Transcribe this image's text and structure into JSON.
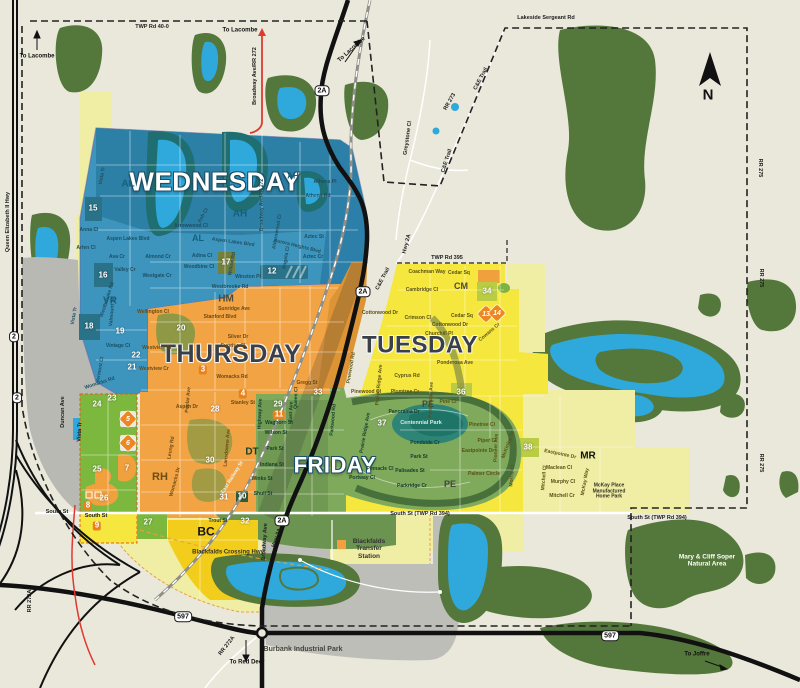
{
  "map_name": "collection-zone-map",
  "colors": {
    "background": "#EAE8DB",
    "forest": "#54783B",
    "water": "#2FA8DC",
    "wednesday": "#3D95BD",
    "thursday": "#F2A444",
    "tuesday": "#F6E73E",
    "friday": "#7FA95B",
    "pale_yellow": "#F0EDA4",
    "west_green": "#7CB83E",
    "bc_gold": "#F2CD1C",
    "gray": "#BEBEB9",
    "marker_orange": "#EE8722",
    "red_road": "#E03A2F"
  },
  "day_zones": [
    {
      "label": "WEDNESDAY",
      "style": "light",
      "x": 215,
      "y": 182,
      "size": 26
    },
    {
      "label": "THURSDAY",
      "style": "dark",
      "x": 231,
      "y": 354,
      "size": 25
    },
    {
      "label": "TUESDAY",
      "style": "dark",
      "x": 420,
      "y": 346,
      "size": 24
    },
    {
      "label": "FRIDAY",
      "style": "light",
      "x": 335,
      "y": 466,
      "size": 22
    }
  ],
  "zone_codes": [
    {
      "code": "AL",
      "x": 128,
      "y": 184,
      "size": 10,
      "color": "#15607e"
    },
    {
      "code": "AH",
      "x": 293,
      "y": 177,
      "size": 8,
      "color": "#15607e"
    },
    {
      "code": "AH",
      "x": 240,
      "y": 214,
      "size": 10,
      "color": "#15607e"
    },
    {
      "code": "AL",
      "x": 198,
      "y": 238,
      "size": 9,
      "color": "#15607e"
    },
    {
      "code": "VR",
      "x": 110,
      "y": 301,
      "size": 10,
      "color": "#15607e"
    },
    {
      "code": "HM",
      "x": 226,
      "y": 299,
      "size": 10,
      "color": "#4a4a3a"
    },
    {
      "code": "DT",
      "x": 252,
      "y": 452,
      "size": 10,
      "color": "#17402c"
    },
    {
      "code": "PE",
      "x": 428,
      "y": 404,
      "size": 9,
      "color": "#45473d"
    },
    {
      "code": "PE",
      "x": 450,
      "y": 484,
      "size": 9,
      "color": "#45473d"
    },
    {
      "code": "CM",
      "x": 461,
      "y": 286,
      "size": 9,
      "color": "#4a4a42"
    },
    {
      "code": "MR",
      "x": 588,
      "y": 456,
      "size": 10,
      "color": "#111111"
    },
    {
      "code": "RH",
      "x": 160,
      "y": 477,
      "size": 11,
      "color": "#6b4d15"
    },
    {
      "code": "BC",
      "x": 206,
      "y": 532,
      "size": 12,
      "color": "#111111"
    }
  ],
  "badges": [
    {
      "n": "15",
      "x": 93,
      "y": 209
    },
    {
      "n": "16",
      "x": 103,
      "y": 276
    },
    {
      "n": "17",
      "x": 226,
      "y": 263
    },
    {
      "n": "18",
      "x": 89,
      "y": 327
    },
    {
      "n": "19",
      "x": 120,
      "y": 332
    },
    {
      "n": "20",
      "x": 181,
      "y": 329
    },
    {
      "n": "21",
      "x": 132,
      "y": 368
    },
    {
      "n": "22",
      "x": 136,
      "y": 356
    },
    {
      "n": "23",
      "x": 112,
      "y": 399
    },
    {
      "n": "24",
      "x": 97,
      "y": 405
    },
    {
      "n": "25",
      "x": 97,
      "y": 470
    },
    {
      "n": "26",
      "x": 104,
      "y": 499
    },
    {
      "n": "27",
      "x": 148,
      "y": 523
    },
    {
      "n": "28",
      "x": 215,
      "y": 410
    },
    {
      "n": "29",
      "x": 278,
      "y": 405
    },
    {
      "n": "30",
      "x": 210,
      "y": 461
    },
    {
      "n": "31",
      "x": 224,
      "y": 498
    },
    {
      "n": "32",
      "x": 245,
      "y": 522
    },
    {
      "n": "33",
      "x": 318,
      "y": 393
    },
    {
      "n": "34",
      "x": 487,
      "y": 292
    },
    {
      "n": "36",
      "x": 461,
      "y": 393
    },
    {
      "n": "37",
      "x": 382,
      "y": 424
    },
    {
      "n": "38",
      "x": 528,
      "y": 448
    },
    {
      "n": "10",
      "x": 242,
      "y": 497
    },
    {
      "n": "12",
      "x": 272,
      "y": 272
    },
    {
      "n": "11",
      "x": 279,
      "y": 415,
      "bg": "orange"
    },
    {
      "n": "3",
      "x": 203,
      "y": 370,
      "bg": "orange"
    },
    {
      "n": "4",
      "x": 243,
      "y": 394,
      "bg": "orange"
    },
    {
      "n": "7",
      "x": 127,
      "y": 469
    },
    {
      "n": "8",
      "x": 88,
      "y": 506,
      "bg": "orange"
    },
    {
      "n": "9",
      "x": 97,
      "y": 526,
      "bg": "orange"
    }
  ],
  "markers": [
    {
      "n": "5",
      "x": 128,
      "y": 419
    },
    {
      "n": "6",
      "x": 128,
      "y": 443
    },
    {
      "n": "13",
      "x": 486,
      "y": 314
    },
    {
      "n": "14",
      "x": 497,
      "y": 313
    }
  ],
  "shields": [
    {
      "t": "2A",
      "x": 322,
      "y": 91
    },
    {
      "t": "2A",
      "x": 363,
      "y": 292
    },
    {
      "t": "2A",
      "x": 282,
      "y": 521
    },
    {
      "t": "2",
      "x": 14,
      "y": 337
    },
    {
      "t": "2",
      "x": 17,
      "y": 398
    },
    {
      "t": "597",
      "x": 183,
      "y": 617
    },
    {
      "t": "597",
      "x": 610,
      "y": 636
    }
  ],
  "streets": [
    {
      "t": "Vista Tr",
      "x": 103,
      "y": 176,
      "r": -80,
      "c": "s-b"
    },
    {
      "t": "Anna Cl",
      "x": 89,
      "y": 231,
      "c": "s-b"
    },
    {
      "t": "Aspen Lakes Blvd",
      "x": 128,
      "y": 240,
      "c": "s-b"
    },
    {
      "t": "Arlen Cl",
      "x": 86,
      "y": 249,
      "c": "s-b"
    },
    {
      "t": "Ava Cr",
      "x": 117,
      "y": 258,
      "c": "s-b"
    },
    {
      "t": "Valley Cr",
      "x": 125,
      "y": 271,
      "c": "s-b"
    },
    {
      "t": "Vista Tr",
      "x": 75,
      "y": 316,
      "r": -80,
      "c": "s-b"
    },
    {
      "t": "Valmount St",
      "x": 113,
      "y": 312,
      "r": -85,
      "c": "s-b"
    },
    {
      "t": "Westbrooke Rd",
      "x": 108,
      "y": 300,
      "r": -72,
      "c": "s-b"
    },
    {
      "t": "Vintage Cl",
      "x": 118,
      "y": 347,
      "c": "s-b"
    },
    {
      "t": "Vermont Cl",
      "x": 101,
      "y": 370,
      "r": -80,
      "c": "s-b"
    },
    {
      "t": "Womacks Rd",
      "x": 100,
      "y": 384,
      "r": -18,
      "c": "s-b"
    },
    {
      "t": "Westgate Cr",
      "x": 157,
      "y": 277,
      "c": "s-b"
    },
    {
      "t": "Almond Cr",
      "x": 158,
      "y": 258,
      "c": "s-b"
    },
    {
      "t": "Arrowwood Cl",
      "x": 191,
      "y": 227,
      "c": "s-b"
    },
    {
      "t": "Ash Cl",
      "x": 204,
      "y": 216,
      "r": -60,
      "c": "s-b"
    },
    {
      "t": "Adina Cl",
      "x": 202,
      "y": 257,
      "c": "s-b"
    },
    {
      "t": "Woodbine Cl",
      "x": 199,
      "y": 268,
      "c": "s-b"
    },
    {
      "t": "Willow Rd",
      "x": 233,
      "y": 264,
      "r": -80,
      "c": "s-b"
    },
    {
      "t": "Winston Pl",
      "x": 248,
      "y": 278,
      "c": "s-b"
    },
    {
      "t": "Westbrooke Rd",
      "x": 230,
      "y": 288,
      "c": "s-b"
    },
    {
      "t": "Aspen Lakes Blvd",
      "x": 233,
      "y": 243,
      "r": 8,
      "c": "s-b"
    },
    {
      "t": "Broadway Ave/RR 272",
      "x": 263,
      "y": 205,
      "r": -90,
      "c": "s-b"
    },
    {
      "t": "Athens Pl",
      "x": 325,
      "y": 183,
      "c": "s-b"
    },
    {
      "t": "Athens Rd",
      "x": 318,
      "y": 197,
      "c": "s-b"
    },
    {
      "t": "Aurora Heights Blvd",
      "x": 297,
      "y": 247,
      "r": 14,
      "c": "s-b"
    },
    {
      "t": "Aztec St",
      "x": 314,
      "y": 238,
      "c": "s-b"
    },
    {
      "t": "Aztec Cr",
      "x": 313,
      "y": 258,
      "c": "s-b"
    },
    {
      "t": "Aldernwood Cl",
      "x": 278,
      "y": 232,
      "r": -80,
      "c": "s-b"
    },
    {
      "t": "Angela Cl",
      "x": 287,
      "y": 258,
      "r": -80,
      "c": "s-b"
    },
    {
      "t": "Wellington Cl",
      "x": 153,
      "y": 313,
      "c": "s-o"
    },
    {
      "t": "Sunridge Ave",
      "x": 234,
      "y": 310,
      "c": "s-o"
    },
    {
      "t": "Stanford Blvd",
      "x": 220,
      "y": 318,
      "c": "s-o"
    },
    {
      "t": "Silver Dr",
      "x": 238,
      "y": 338,
      "c": "s-o"
    },
    {
      "t": "Sunrise Cl",
      "x": 233,
      "y": 347,
      "c": "s-o"
    },
    {
      "t": "Westview Cr",
      "x": 157,
      "y": 349,
      "c": "s-o"
    },
    {
      "t": "Westview Cr",
      "x": 154,
      "y": 370,
      "c": "s-o"
    },
    {
      "t": "Womacks Rd",
      "x": 232,
      "y": 378,
      "c": "s-o"
    },
    {
      "t": "Gregg St",
      "x": 307,
      "y": 384,
      "c": "s-o"
    },
    {
      "t": "Aspen Dr",
      "x": 187,
      "y": 408,
      "c": "s-o"
    },
    {
      "t": "Stanley St",
      "x": 243,
      "y": 404,
      "c": "s-o"
    },
    {
      "t": "Poplar Ave",
      "x": 189,
      "y": 400,
      "r": -85,
      "c": "s-o"
    },
    {
      "t": "Lansdowne Ave",
      "x": 228,
      "y": 448,
      "r": -85,
      "c": "s-o"
    },
    {
      "t": "Leung Rd",
      "x": 172,
      "y": 448,
      "r": -80,
      "c": "s-o"
    },
    {
      "t": "Womacks Dr",
      "x": 176,
      "y": 482,
      "r": -75,
      "c": "s-o"
    },
    {
      "t": "Waghorn St",
      "x": 279,
      "y": 424,
      "c": "s-g"
    },
    {
      "t": "Wilson St",
      "x": 276,
      "y": 434,
      "c": "s-g"
    },
    {
      "t": "Park St",
      "x": 275,
      "y": 450,
      "c": "s-g"
    },
    {
      "t": "East Ave",
      "x": 292,
      "y": 412,
      "r": -88,
      "c": "s-g"
    },
    {
      "t": "Highway Ave",
      "x": 261,
      "y": 414,
      "r": -88,
      "c": "s-g"
    },
    {
      "t": "Queen Cl",
      "x": 297,
      "y": 398,
      "r": -88,
      "c": "s-g"
    },
    {
      "t": "Indiana St",
      "x": 272,
      "y": 466,
      "c": "s-g"
    },
    {
      "t": "Winks St",
      "x": 262,
      "y": 480,
      "c": "s-g"
    },
    {
      "t": "Shull St",
      "x": 263,
      "y": 495,
      "c": "s-g"
    },
    {
      "t": "Trout St",
      "x": 218,
      "y": 522,
      "c": "s-g"
    },
    {
      "t": "East Railway St",
      "x": 233,
      "y": 478,
      "r": -58,
      "c": "s-w"
    },
    {
      "t": "Panorama Dr",
      "x": 404,
      "y": 413,
      "c": "s-g"
    },
    {
      "t": "Pondside Cr",
      "x": 425,
      "y": 444,
      "c": "s-g"
    },
    {
      "t": "Park St",
      "x": 419,
      "y": 458,
      "c": "s-g"
    },
    {
      "t": "Pinnacle Cl",
      "x": 380,
      "y": 470,
      "c": "s-g"
    },
    {
      "t": "Palisades St",
      "x": 410,
      "y": 472,
      "c": "s-g"
    },
    {
      "t": "Parkridge Cr",
      "x": 412,
      "y": 487,
      "c": "s-g"
    },
    {
      "t": "Portway Cl",
      "x": 362,
      "y": 479,
      "c": "s-g"
    },
    {
      "t": "Parkwood Rd",
      "x": 334,
      "y": 420,
      "r": -85,
      "c": "s-g"
    },
    {
      "t": "Prairie Ridge Ave",
      "x": 366,
      "y": 433,
      "r": -80,
      "c": "s-g"
    },
    {
      "t": "Coachman Way",
      "x": 427,
      "y": 273,
      "c": "s-y"
    },
    {
      "t": "Cedar Sq",
      "x": 459,
      "y": 274,
      "c": "s-y"
    },
    {
      "t": "Cedar Sq",
      "x": 462,
      "y": 317,
      "c": "s-y"
    },
    {
      "t": "Cambridge Cl",
      "x": 422,
      "y": 291,
      "c": "s-y"
    },
    {
      "t": "Crimson Cl",
      "x": 418,
      "y": 319,
      "c": "s-y"
    },
    {
      "t": "Cottonwood Dr",
      "x": 380,
      "y": 314,
      "c": "s-y"
    },
    {
      "t": "Cottonwood Dr",
      "x": 450,
      "y": 326,
      "c": "s-y"
    },
    {
      "t": "Churchill Pl",
      "x": 439,
      "y": 335,
      "c": "s-y"
    },
    {
      "t": "Cowans Cr",
      "x": 490,
      "y": 333,
      "r": -40,
      "c": "s-y"
    },
    {
      "t": "Ponderosa Ave",
      "x": 455,
      "y": 364,
      "c": "s-y"
    },
    {
      "t": "Ponderosa Ave",
      "x": 432,
      "y": 400,
      "r": -88,
      "c": "s-y"
    },
    {
      "t": "Cyprus Rd",
      "x": 407,
      "y": 377,
      "c": "s-y"
    },
    {
      "t": "Plumtree Cr",
      "x": 405,
      "y": 393,
      "c": "s-y"
    },
    {
      "t": "Prairie Ridge Ave",
      "x": 380,
      "y": 385,
      "r": -85,
      "c": "s-y"
    },
    {
      "t": "Pinewood Cl",
      "x": 366,
      "y": 393,
      "c": "s-y"
    },
    {
      "t": "Pinewood Rd",
      "x": 352,
      "y": 368,
      "r": -80,
      "c": "s-y"
    },
    {
      "t": "Pine Cl",
      "x": 448,
      "y": 403,
      "c": "s-y"
    },
    {
      "t": "Piper Cl",
      "x": 487,
      "y": 442,
      "c": "s-y"
    },
    {
      "t": "Pinetree Cl",
      "x": 482,
      "y": 426,
      "c": "s-y"
    },
    {
      "t": "Eastpointe Dr",
      "x": 478,
      "y": 452,
      "c": "s-y"
    },
    {
      "t": "Pioneer Ave",
      "x": 497,
      "y": 448,
      "r": -88,
      "c": "s-y"
    },
    {
      "t": "Palmer Circle",
      "x": 484,
      "y": 475,
      "c": "s-y"
    },
    {
      "t": "McKinley Dr",
      "x": 509,
      "y": 445,
      "r": -70,
      "c": "s-y"
    },
    {
      "t": "Morris Cl",
      "x": 513,
      "y": 476,
      "r": -85,
      "c": "s-y"
    },
    {
      "t": "Mitchell Cl",
      "x": 545,
      "y": 478,
      "r": -85,
      "c": "s-y"
    },
    {
      "t": "Maclean Cl",
      "x": 559,
      "y": 469,
      "c": "s-y"
    },
    {
      "t": "Murphy Cl",
      "x": 563,
      "y": 483,
      "c": "s-y"
    },
    {
      "t": "Mitchell Cr",
      "x": 562,
      "y": 497,
      "c": "s-y"
    },
    {
      "t": "McKay Way",
      "x": 586,
      "y": 482,
      "r": -80,
      "c": "s-y"
    },
    {
      "t": "Eastpointe Dr",
      "x": 560,
      "y": 455,
      "r": 12,
      "c": "s-y"
    }
  ],
  "roads": [
    {
      "t": "TWP Rd 40-0",
      "x": 152,
      "y": 27
    },
    {
      "t": "Lakeside Sergeant Rd",
      "x": 546,
      "y": 18
    },
    {
      "t": "TWP Rd 395",
      "x": 447,
      "y": 258
    },
    {
      "t": "South St",
      "x": 57,
      "y": 512
    },
    {
      "t": "South St",
      "x": 96,
      "y": 516
    },
    {
      "t": "South St (TWP Rd 394)",
      "x": 420,
      "y": 514
    },
    {
      "t": "South St (TWP Rd 394)",
      "x": 657,
      "y": 518
    },
    {
      "t": "C&E Trail",
      "x": 481,
      "y": 79,
      "r": -62
    },
    {
      "t": "C&E Trail",
      "x": 447,
      "y": 161,
      "r": -72
    },
    {
      "t": "C&E Trail",
      "x": 383,
      "y": 279,
      "r": -62
    },
    {
      "t": "RR 273",
      "x": 450,
      "y": 102,
      "r": -60
    },
    {
      "t": "RR 275",
      "x": 760,
      "y": 168,
      "r": 90
    },
    {
      "t": "RR 275",
      "x": 761,
      "y": 278,
      "r": 90
    },
    {
      "t": "RR 275",
      "x": 761,
      "y": 463,
      "r": 90
    },
    {
      "t": "Queen Elizabeth II Hwy",
      "x": 8,
      "y": 222,
      "r": -90
    },
    {
      "t": "Broadway Ave/RR 272",
      "x": 255,
      "y": 76,
      "r": -90
    },
    {
      "t": "Broadway Ave",
      "x": 265,
      "y": 542,
      "r": -87
    },
    {
      "t": "Hwy 2A",
      "x": 407,
      "y": 244,
      "r": -75
    },
    {
      "t": "Hwy 2A",
      "x": 277,
      "y": 538,
      "r": -70
    },
    {
      "t": "RR 272A",
      "x": 227,
      "y": 646,
      "r": -52
    },
    {
      "t": "RR 272A",
      "x": 30,
      "y": 601,
      "r": -90
    },
    {
      "t": "Duncan Ave",
      "x": 63,
      "y": 412,
      "r": -90
    },
    {
      "t": "Vista Tr",
      "x": 80,
      "y": 432,
      "r": -87
    },
    {
      "t": "Greystone Cl",
      "x": 408,
      "y": 138,
      "r": -82
    }
  ],
  "directions": [
    {
      "t": "To Lacombe",
      "x": 37,
      "y": 57
    },
    {
      "t": "To Lacombe",
      "x": 240,
      "y": 31
    },
    {
      "t": "To Lacombe",
      "x": 352,
      "y": 50,
      "r": -42
    },
    {
      "t": "To Red Deer",
      "x": 247,
      "y": 663
    },
    {
      "t": "To Joffre",
      "x": 697,
      "y": 655
    }
  ],
  "pois": [
    {
      "t": "Blackfalds\nTransfer\nStation",
      "x": 369,
      "y": 549,
      "c": "#333333",
      "fs": 6.5
    },
    {
      "t": "Burbank Industrial Park",
      "x": 303,
      "y": 650,
      "c": "#44443c",
      "fs": 7
    },
    {
      "t": "Mary & Cliff Soper\nNatural Area",
      "x": 707,
      "y": 561,
      "c": "#ffffff",
      "fs": 6.5
    },
    {
      "t": "Centennial Park",
      "x": 421,
      "y": 423,
      "c": "#d8ecdf",
      "fs": 5.5
    },
    {
      "t": "Blackfalds Crossing Hwy",
      "x": 228,
      "y": 553,
      "c": "#333322",
      "fs": 6
    },
    {
      "t": "McKay Place\nManufactured\nHome Park",
      "x": 609,
      "y": 492,
      "c": "#333322",
      "fs": 5
    }
  ],
  "compass": {
    "letter": "N",
    "x": 708,
    "y": 96
  }
}
